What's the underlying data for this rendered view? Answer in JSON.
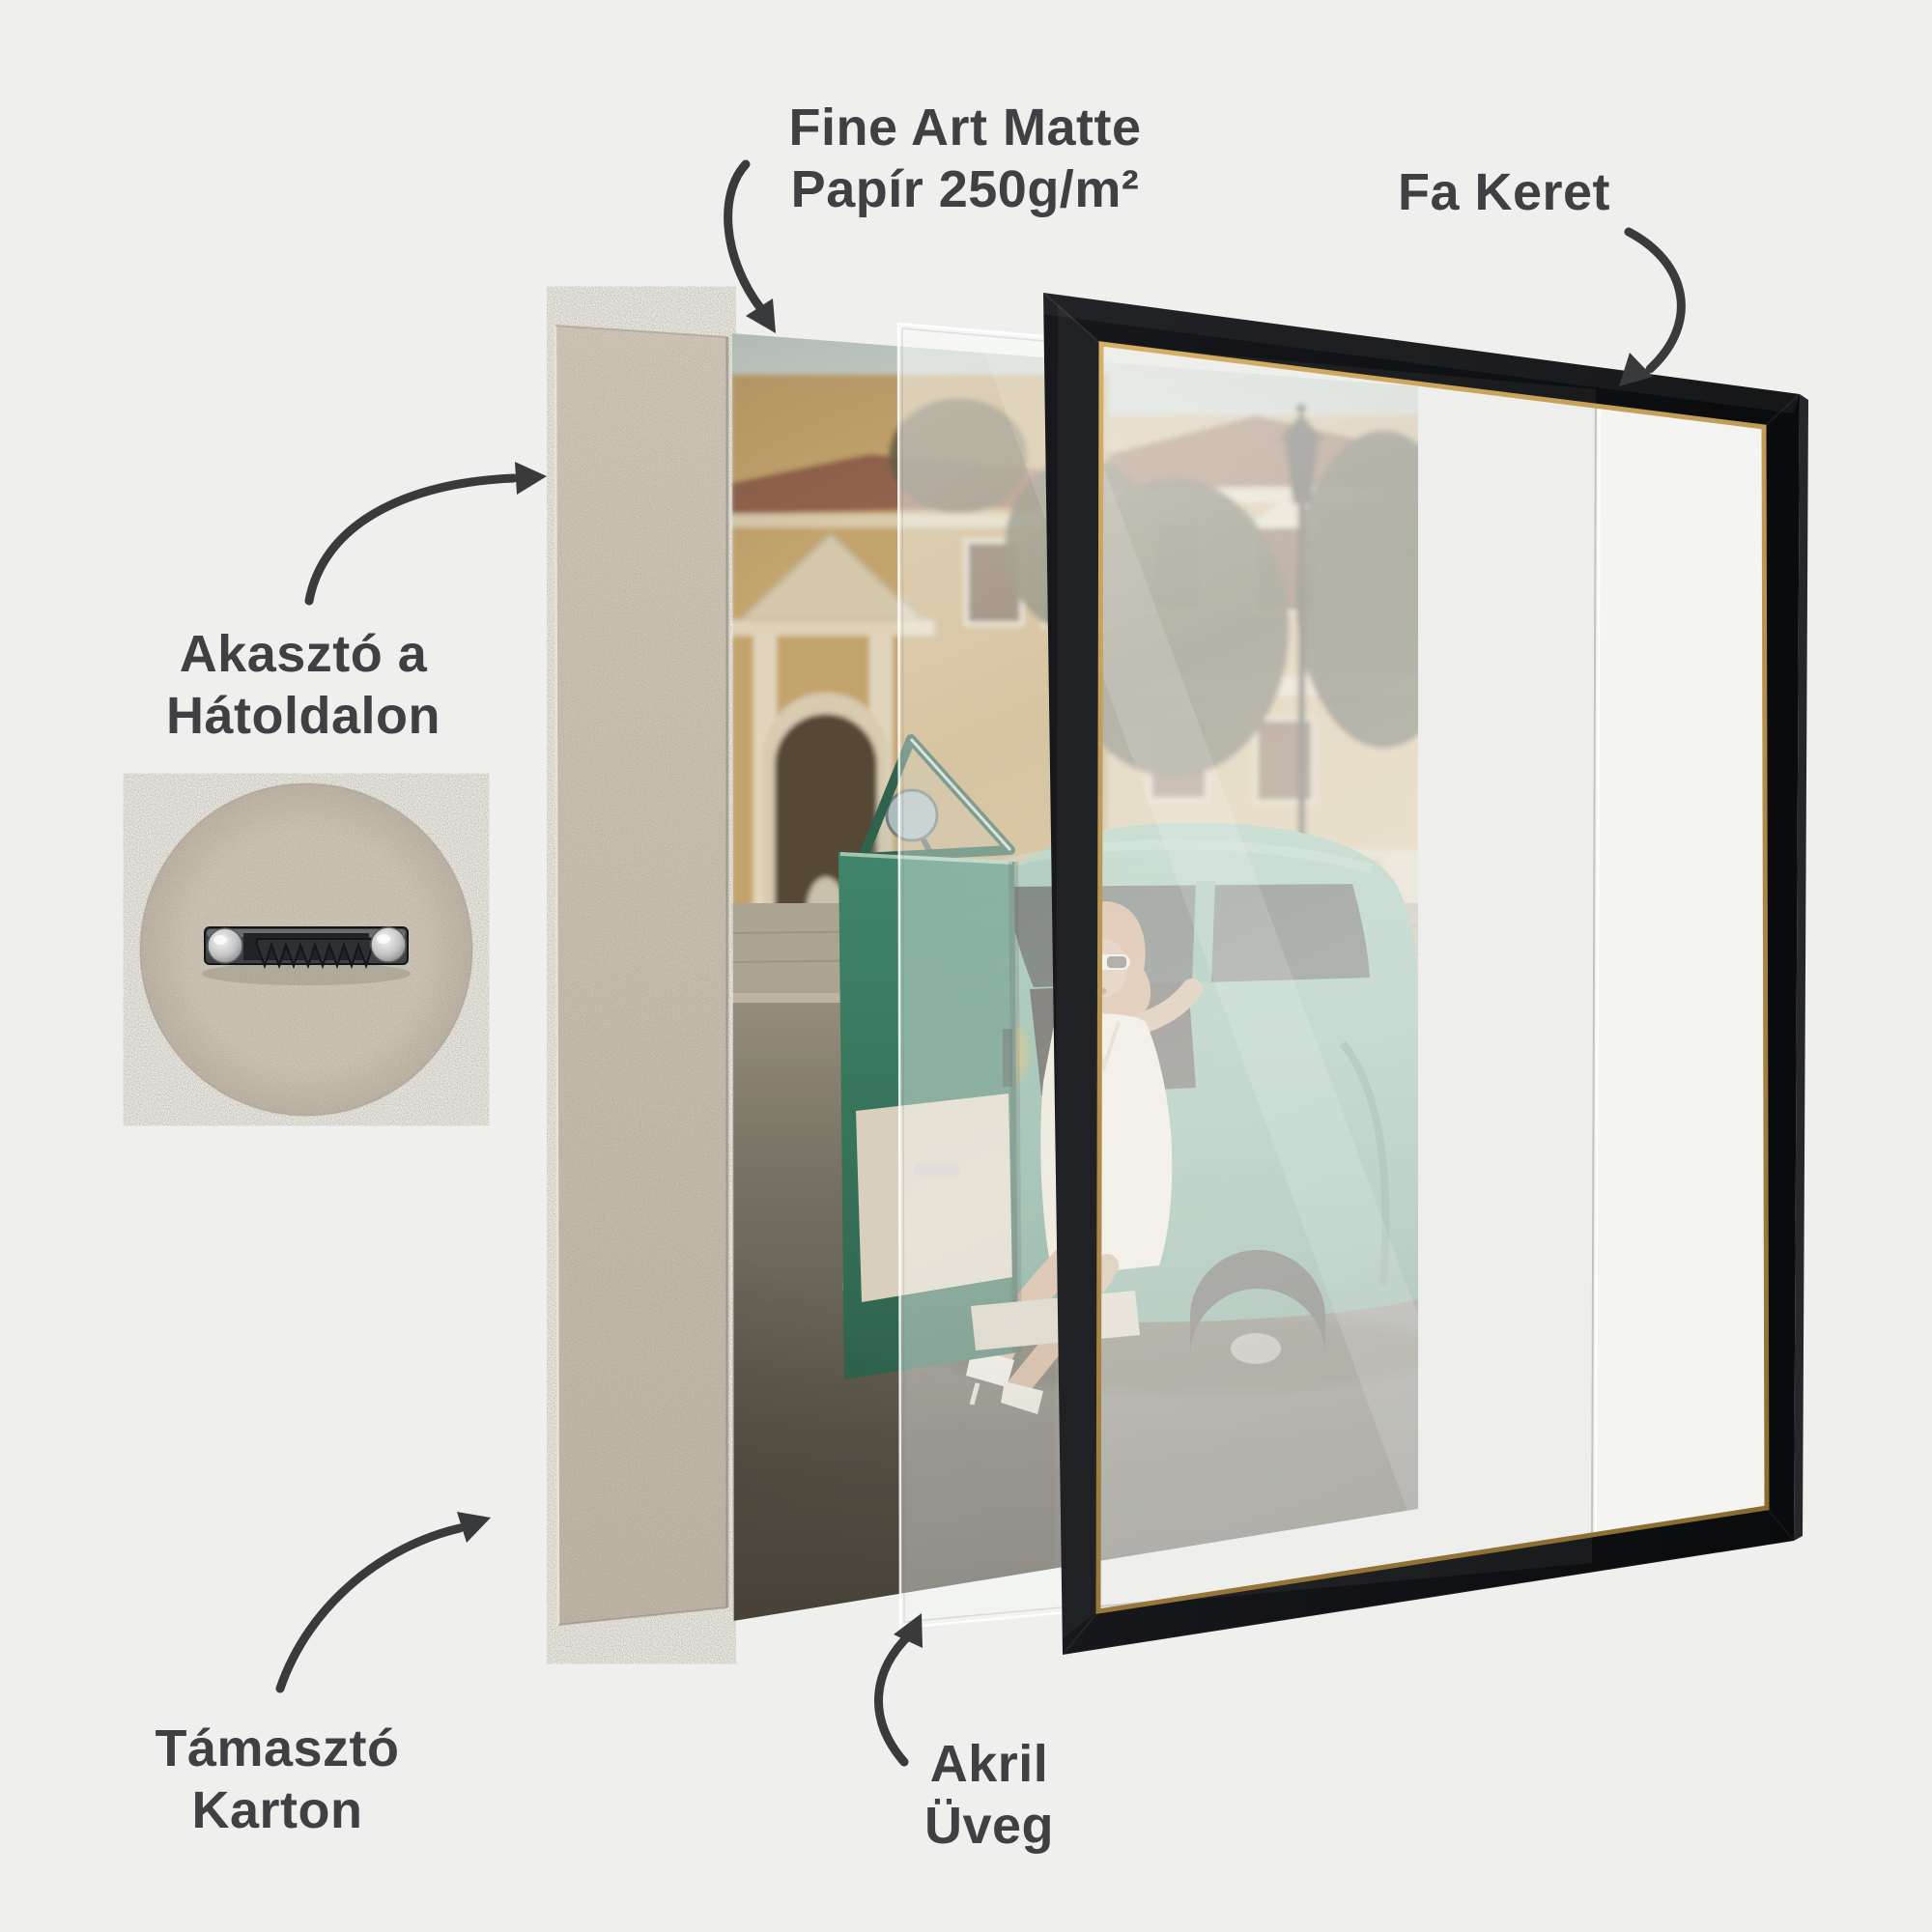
{
  "scene": {
    "background_color": "#eff0ee",
    "text_color": "#3e4043",
    "arrow_color": "#393a3c"
  },
  "labels": {
    "paper": {
      "line1": "Fine Art Matte",
      "line2": "Papír 250g/m²"
    },
    "frame": {
      "line1": "Fa Keret"
    },
    "hanger": {
      "line1": "Akasztó a",
      "line2": "Hátoldalon"
    },
    "backing": {
      "line1": "Támasztó",
      "line2": "Karton"
    },
    "acrylic": {
      "line1": "Akril",
      "line2": "Üveg"
    }
  },
  "materials": {
    "frame_color": "#0d0e10",
    "gold_trim_color": "#b08b45",
    "backing_board_color": "#d3cbbd",
    "mat_white_color": "#f4f5f3",
    "acrylic_tint_color": "#f7f9f8",
    "car_teal_color": "#5f9c86"
  }
}
